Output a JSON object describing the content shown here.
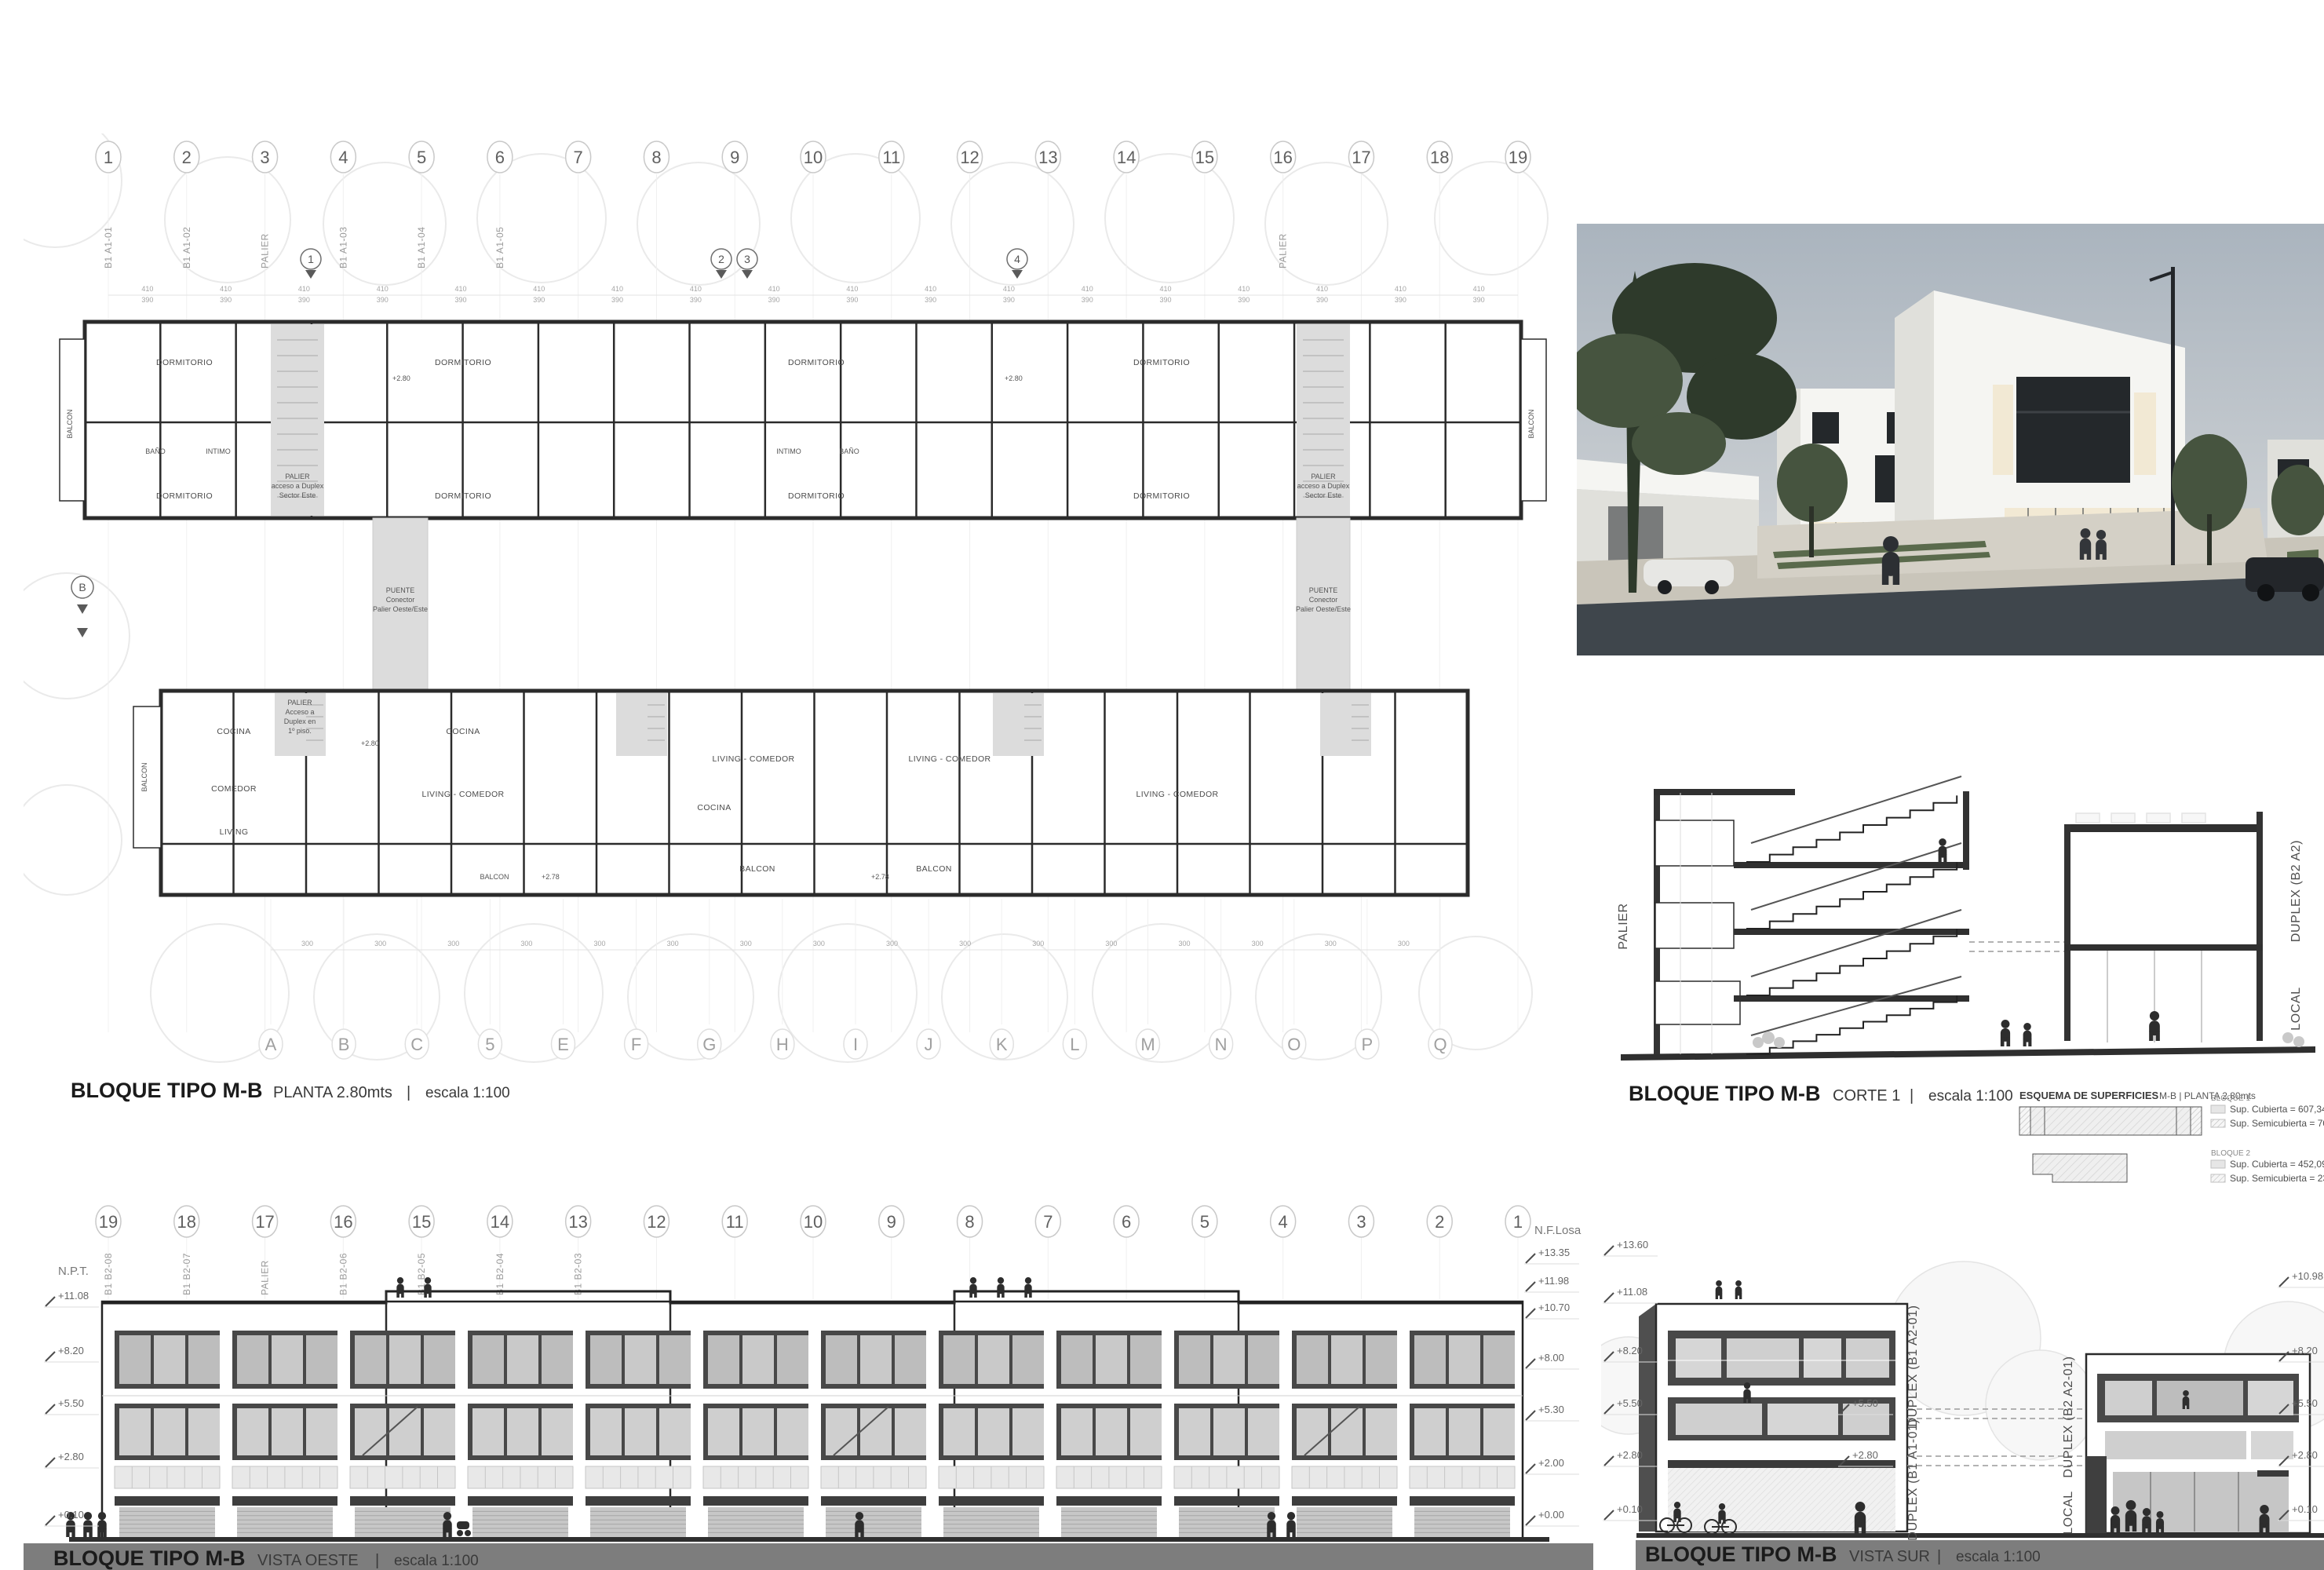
{
  "colors": {
    "title_bar": "#7d7d7d",
    "band_dark": "#484848",
    "palier_fill": "#dcdcdc",
    "line_dark": "#2b2b2b"
  },
  "plan": {
    "title": "BLOQUE TIPO M-B",
    "subtitle": "PLANTA 2.80mts",
    "divider": "|",
    "scale": "escala 1:100",
    "grid_top": [
      "1",
      "2",
      "3",
      "4",
      "5",
      "6",
      "7",
      "8",
      "9",
      "10",
      "11",
      "12",
      "13",
      "14",
      "15",
      "16",
      "17",
      "18",
      "19"
    ],
    "grid_top_codes": [
      "B1 A1-01",
      "B1 A1-02",
      "PALIER",
      "B1 A1-03",
      "B1 A1-04",
      "B1 A1-05",
      "",
      "",
      "",
      "",
      "",
      "",
      "",
      "",
      "",
      "PALIER",
      "",
      "",
      ""
    ],
    "grid_bottom": [
      "A",
      "B",
      "C",
      "5",
      "E",
      "F",
      "G",
      "H",
      "I",
      "J",
      "K",
      "L",
      "M",
      "N",
      "O",
      "P",
      "Q"
    ],
    "section_cut_labels": [
      "1",
      "2",
      "3",
      "4"
    ],
    "section_marker": "B",
    "labels": {
      "dormitorio": "DORMITORIO",
      "bano": "BAÑO",
      "intimo": "INTIMO",
      "balcon": "BALCON",
      "cocina": "COCINA",
      "comedor": "COMEDOR",
      "living": "LIVING",
      "living_comedor": "LIVING - COMEDOR",
      "nivel_280": "+2.80",
      "nivel_278": "+2.78"
    },
    "palier_upper_lines": [
      "PALIER",
      "acceso a Duplex",
      "Sector Este"
    ],
    "palier_lower_lines": [
      "PALIER",
      "Acceso a",
      "Duplex en",
      "1º piso."
    ],
    "puente_lines": [
      "PUENTE",
      "Conector",
      "Palier Oeste/Este"
    ],
    "dims": [
      "410",
      "390",
      "300",
      "122",
      "143",
      "85",
      "150"
    ]
  },
  "section": {
    "title": "BLOQUE TIPO M-B",
    "subtitle": "CORTE 1",
    "divider": "|",
    "scale": "escala 1:100",
    "label_left": "PALIER",
    "labels_right": [
      "DUPLEX (B2 A2)",
      "LOCAL"
    ]
  },
  "esquema": {
    "title": "ESQUEMA DE SUPERFICIES",
    "subtitle": "M-B | PLANTA 2.80mts",
    "bloques": [
      {
        "name": "BLOQUE 1",
        "cubierta": "Sup. Cubierta = 607,34",
        "semicubierta": "Sup. Semicubierta = 70,97"
      },
      {
        "name": "BLOQUE 2",
        "cubierta": "Sup. Cubierta = 452,09",
        "semicubierta": "Sup. Semicubierta = 233,33"
      }
    ]
  },
  "vista_oeste": {
    "title": "BLOQUE TIPO M-B",
    "subtitle": "VISTA OESTE",
    "divider": "|",
    "scale": "escala 1:100",
    "grid": [
      "19",
      "18",
      "17",
      "16",
      "15",
      "14",
      "13",
      "12",
      "11",
      "10",
      "9",
      "8",
      "7",
      "6",
      "5",
      "4",
      "3",
      "2",
      "1"
    ],
    "grid_codes": [
      "B1 B2-08",
      "B1 B2-07",
      "PALIER",
      "B1 B2-06",
      "B1 B2-05",
      "B1 B2-04",
      "B1 B2-03",
      "",
      "",
      "",
      "",
      "",
      "",
      "",
      "",
      "",
      "",
      "",
      ""
    ],
    "levels_left_label": "N.P.T.",
    "levels_left": [
      "+11.08",
      "+8.20",
      "+5.50",
      "+2.80",
      "+0.10"
    ],
    "levels_right_label": "N.F.Losa",
    "levels_right": [
      "+13.35",
      "+11.98",
      "+10.70",
      "+8.00",
      "+5.30",
      "+2.00",
      "+0.00"
    ]
  },
  "vista_sur": {
    "title": "BLOQUE TIPO M-B",
    "subtitle": "VISTA SUR",
    "divider": "|",
    "scale": "escala 1:100",
    "levels_left": [
      "+13.60",
      "+11.08",
      "+8.20",
      "+5.50",
      "+2.80",
      "+0.10"
    ],
    "levels_right": [
      "+10.98",
      "+8.20",
      "+5.50",
      "+2.80",
      "+0.10"
    ],
    "levels_mid": [
      "+5.50",
      "+2.80"
    ],
    "unit_labels": [
      "DUPLEX (B1 A2-01)",
      "DUPLEX (B1 A1-01)",
      "DUPLEX (B2 A2-01)",
      "LOCAL"
    ]
  },
  "render": {
    "sky_top": "#aab4be",
    "sky_bottom": "#d8dadb",
    "building_white": "#f5f5f2",
    "building_shade": "#e0e0db",
    "window_dark": "#24282b",
    "window_lit": "#f2e9d4",
    "asphalt": "#3f464c",
    "pavement": "#c9c5ba",
    "plaza": "#d4d0c6",
    "grass": "#5a6a4c",
    "foliage_dark": "#2e3a2b",
    "foliage_mid": "#46543f",
    "car_dark": "#23262a",
    "car_light": "#e7e7e4"
  }
}
